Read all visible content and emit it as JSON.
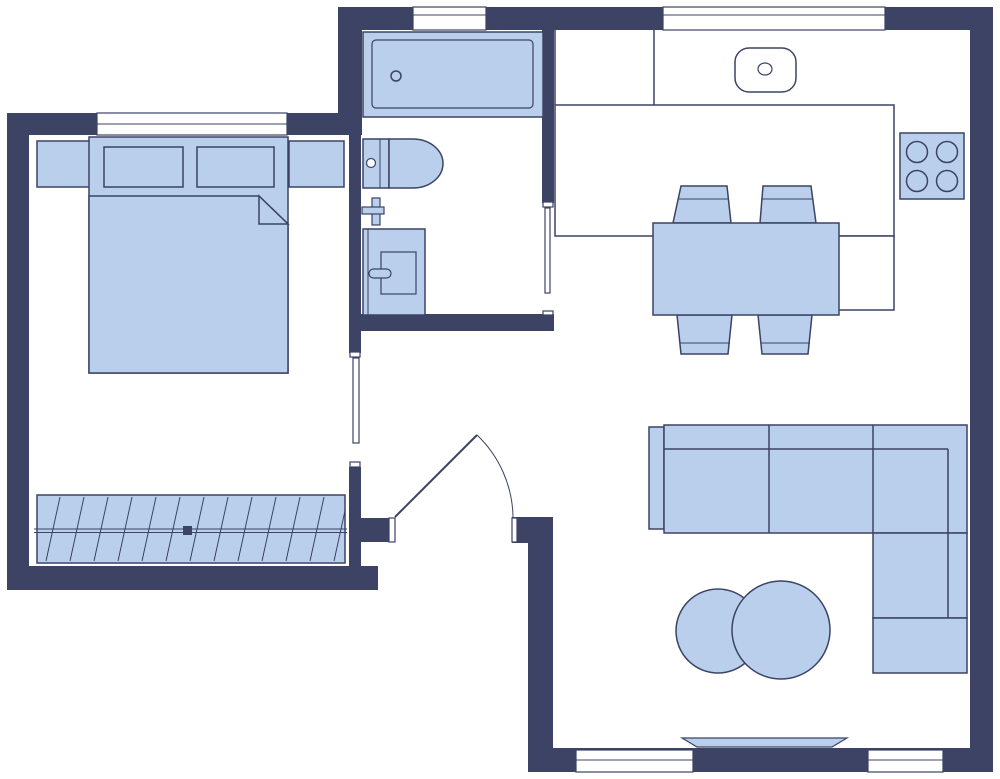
{
  "meta": {
    "title": "Apartment floor plan",
    "canvas_width": 1000,
    "canvas_height": 779
  },
  "colors": {
    "wall": "#3c4365",
    "furniture": "#b9cfec",
    "outline": "#3c4365",
    "floor": "#ffffff",
    "background": "#ffffff"
  },
  "plan": {
    "type": "2d-floor-plan",
    "visible_text": "none",
    "rooms": [
      {
        "name": "bedroom",
        "position": "left",
        "furniture": [
          "double-bed",
          "pillow-left",
          "pillow-right",
          "blanket-with-folded-corner",
          "nightstand-left",
          "nightstand-right",
          "sliding-wardrobe-with-rail"
        ],
        "openings": [
          "window-top",
          "sliding-door-to-hallway"
        ]
      },
      {
        "name": "bathroom",
        "position": "top-center",
        "furniture": [
          "bathtub-with-drain",
          "toilet-with-cistern",
          "wall-faucet-cross",
          "washing-machine-with-door-handle"
        ],
        "openings": [
          "window-top",
          "sliding-door-to-hallway"
        ]
      },
      {
        "name": "kitchen-living-room",
        "position": "right",
        "furniture": [
          "kitchen-counter-with-divider",
          "kitchen-sink",
          "cooktop-4-burners",
          "counter-bench-return",
          "dining-table",
          "dining-chair-1",
          "dining-chair-2",
          "dining-chair-3",
          "dining-chair-4",
          "corner-sofa-with-chaise",
          "coffee-table-small",
          "coffee-table-large",
          "tv-panel"
        ],
        "openings": [
          "window-kitchen-top",
          "window-bottom-left",
          "window-bottom-right",
          "entry-door-with-swing-arc"
        ]
      },
      {
        "name": "hallway",
        "position": "center",
        "furniture": [],
        "openings": [
          "entry-door"
        ]
      }
    ]
  }
}
